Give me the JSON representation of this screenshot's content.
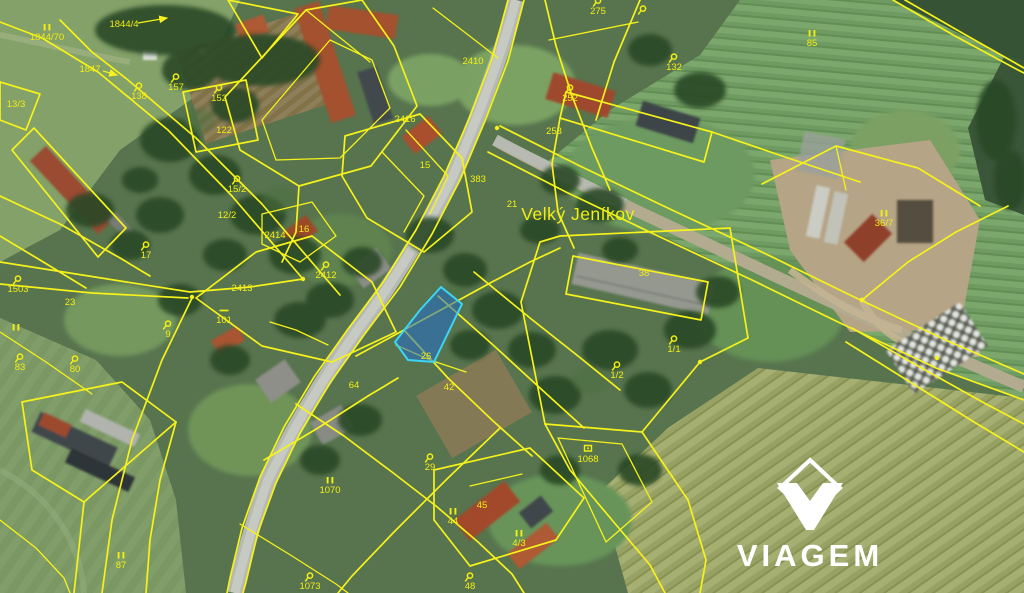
{
  "map": {
    "place_label": "Velký Jeníkov",
    "line_color": "#f6f21b",
    "label_color": "#f2ee14",
    "highlight": {
      "fill": "rgba(35,110,205,0.55)",
      "stroke": "#3cd6f2",
      "label": "26"
    },
    "parcel_labels": [
      {
        "text": "1844/70",
        "symbol": "bars",
        "x": 47,
        "y": 40
      },
      {
        "text": "1844/4",
        "x": 124,
        "y": 27
      },
      {
        "text": "1847",
        "x": 90,
        "y": 72
      },
      {
        "text": "138",
        "symbol": "hook",
        "x": 139,
        "y": 99
      },
      {
        "text": "157",
        "symbol": "hook",
        "x": 176,
        "y": 90
      },
      {
        "text": "152",
        "symbol": "hook",
        "x": 219,
        "y": 101
      },
      {
        "text": "122",
        "x": 224,
        "y": 133
      },
      {
        "text": "13/3",
        "x": 16,
        "y": 107
      },
      {
        "text": "1503",
        "symbol": "hook",
        "x": 18,
        "y": 292
      },
      {
        "text": "",
        "symbol": "bars",
        "x": 16,
        "y": 340
      },
      {
        "text": "83",
        "symbol": "hook",
        "x": 20,
        "y": 370
      },
      {
        "text": "80",
        "symbol": "hook",
        "x": 75,
        "y": 372
      },
      {
        "text": "23",
        "x": 70,
        "y": 305
      },
      {
        "text": "9",
        "symbol": "hook",
        "x": 168,
        "y": 337
      },
      {
        "text": "17",
        "symbol": "hook",
        "x": 146,
        "y": 258
      },
      {
        "text": "12/2",
        "x": 227,
        "y": 218
      },
      {
        "text": "15/2",
        "symbol": "hook",
        "x": 237,
        "y": 192
      },
      {
        "text": "16",
        "x": 304,
        "y": 232
      },
      {
        "text": "2414",
        "x": 275,
        "y": 238
      },
      {
        "text": "2413",
        "x": 242,
        "y": 291
      },
      {
        "text": "101",
        "symbol": "dash",
        "x": 224,
        "y": 323
      },
      {
        "text": "2412",
        "symbol": "hook",
        "x": 326,
        "y": 278
      },
      {
        "text": "2410",
        "x": 473,
        "y": 64
      },
      {
        "text": "2416",
        "x": 405,
        "y": 122
      },
      {
        "text": "15",
        "x": 425,
        "y": 168
      },
      {
        "text": "383",
        "x": 478,
        "y": 182
      },
      {
        "text": "21",
        "x": 512,
        "y": 207
      },
      {
        "text": "275",
        "symbol": "hook",
        "x": 598,
        "y": 14
      },
      {
        "text": "",
        "symbol": "hook",
        "x": 643,
        "y": 22
      },
      {
        "text": "252",
        "symbol": "hook",
        "x": 570,
        "y": 101
      },
      {
        "text": "253",
        "x": 554,
        "y": 134
      },
      {
        "text": "132",
        "symbol": "hook",
        "x": 674,
        "y": 70
      },
      {
        "text": "85",
        "symbol": "bars",
        "x": 812,
        "y": 46
      },
      {
        "text": "36/7",
        "symbol": "bars",
        "x": 884,
        "y": 226
      },
      {
        "text": "38",
        "x": 644,
        "y": 276
      },
      {
        "text": "1/1",
        "symbol": "hook",
        "x": 674,
        "y": 352
      },
      {
        "text": "1/2",
        "symbol": "hook",
        "x": 617,
        "y": 378
      },
      {
        "text": "26",
        "x": 426,
        "y": 359
      },
      {
        "text": "42",
        "x": 449,
        "y": 390
      },
      {
        "text": "64",
        "x": 354,
        "y": 388
      },
      {
        "text": "87",
        "symbol": "bars",
        "x": 121,
        "y": 568
      },
      {
        "text": "1070",
        "symbol": "bars",
        "x": 330,
        "y": 493
      },
      {
        "text": "29",
        "symbol": "hook",
        "x": 430,
        "y": 470
      },
      {
        "text": "44",
        "symbol": "bars",
        "x": 453,
        "y": 524
      },
      {
        "text": "45",
        "x": 482,
        "y": 508
      },
      {
        "text": "4/3",
        "symbol": "bars",
        "x": 519,
        "y": 546
      },
      {
        "text": "1068",
        "symbol": "house",
        "x": 588,
        "y": 462
      },
      {
        "text": "1073",
        "symbol": "hook",
        "x": 310,
        "y": 589
      },
      {
        "text": "48",
        "symbol": "hook",
        "x": 470,
        "y": 589
      }
    ]
  },
  "logo": {
    "wordmark": "VIAGEM",
    "color": "#ffffff",
    "icon": "viagem-gem-icon"
  }
}
